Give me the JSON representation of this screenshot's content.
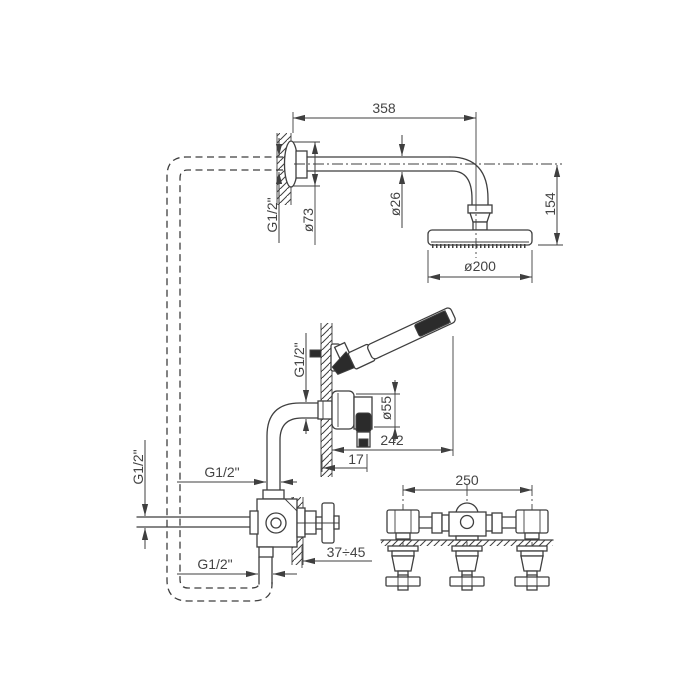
{
  "drawing": {
    "type": "technical-drawing",
    "subject": "Wall-mounted shower system: overhead rain shower arm, hand shower outlet and 3-handle built-in diverter manifold",
    "colors": {
      "line": "#3f3f3f",
      "text": "#444444",
      "background": "#ffffff",
      "dark_fill": "#2b2b2b"
    },
    "dimensions": {
      "arm_length": "358",
      "arm_wall_thread": "G1/2\"",
      "flange_diameter": "ø73",
      "arm_tube_diameter": "ø26",
      "head_drop_height": "154",
      "head_diameter": "ø200",
      "handshower_supply_thread": "G1/2\"",
      "outlet_escutcheon_diameter": "ø55",
      "handshower_reach": "242",
      "outlet_offset": "17",
      "inlet_thread": "G1/2\"",
      "valve_top_thread": "G1/2\"",
      "valve_bottom_thread": "G1/2\"",
      "rough_in_depth_range": "37÷45",
      "manifold_center_distance": "250"
    }
  }
}
